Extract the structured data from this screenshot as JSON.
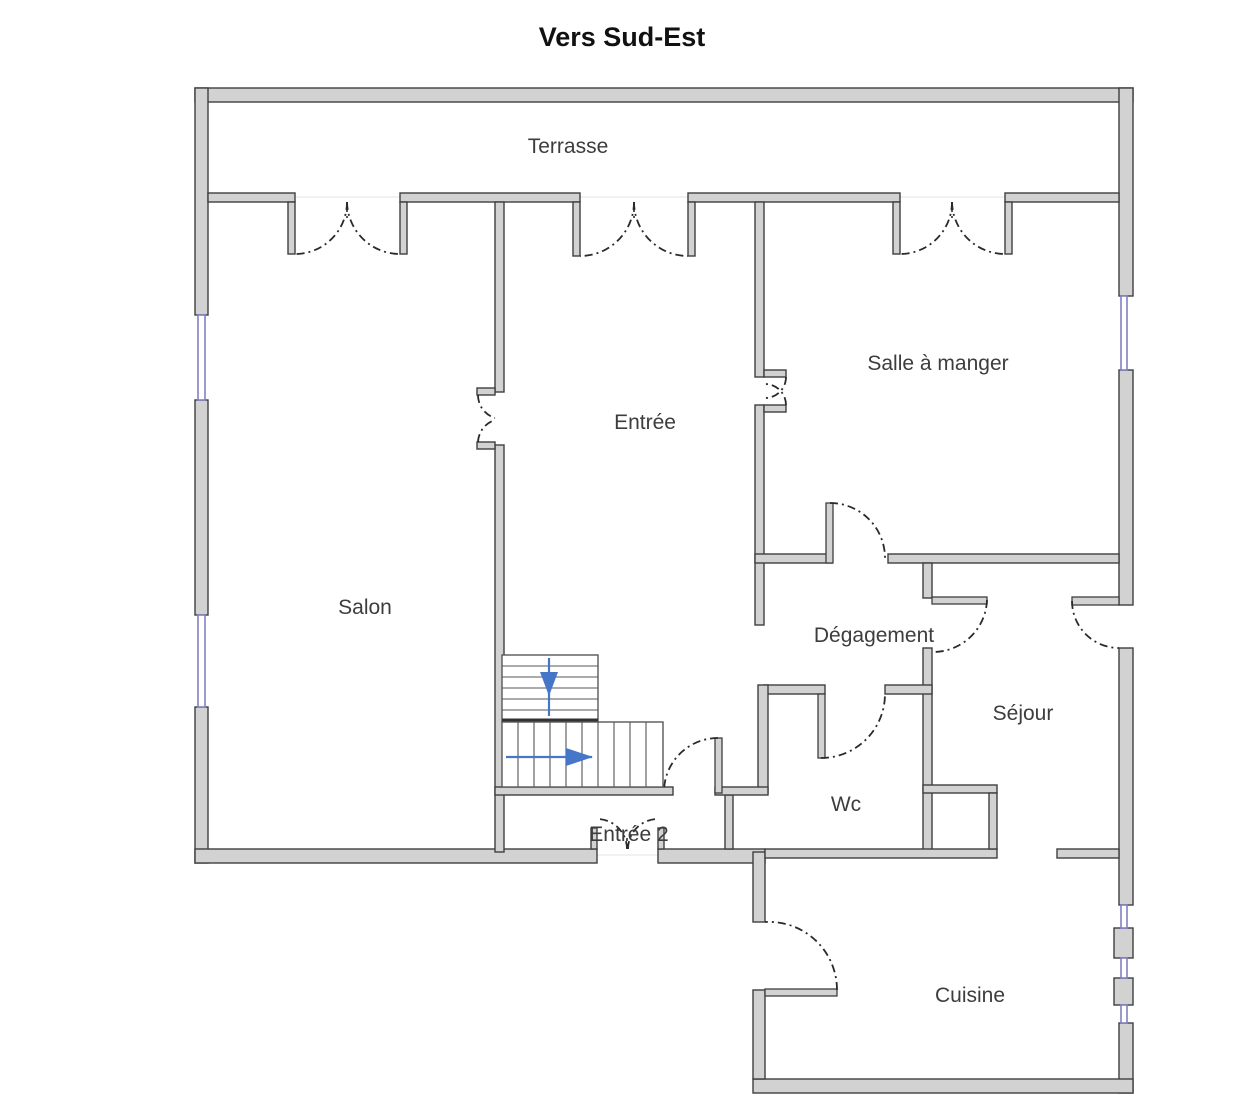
{
  "title": "Vers Sud-Est",
  "colors": {
    "bg": "#ffffff",
    "wall_fill": "#d2d2d2",
    "wall_stroke": "#3f3f3f",
    "window_stroke": "#8080c5",
    "arc_stroke": "#2a2a2a",
    "arrow_color": "#4576c8",
    "label_color": "#3d3d3d",
    "title_color": "#111111"
  },
  "rooms": {
    "terrasse": {
      "label": "Terrasse"
    },
    "salle_a_manger": {
      "label": "Salle à manger"
    },
    "entree": {
      "label": "Entrée"
    },
    "salon": {
      "label": "Salon"
    },
    "degagement": {
      "label": "Dégagement"
    },
    "sejour": {
      "label": "Séjour"
    },
    "wc": {
      "label": "Wc"
    },
    "entree2": {
      "label": "Entrée 2"
    },
    "cuisine": {
      "label": "Cuisine"
    }
  }
}
